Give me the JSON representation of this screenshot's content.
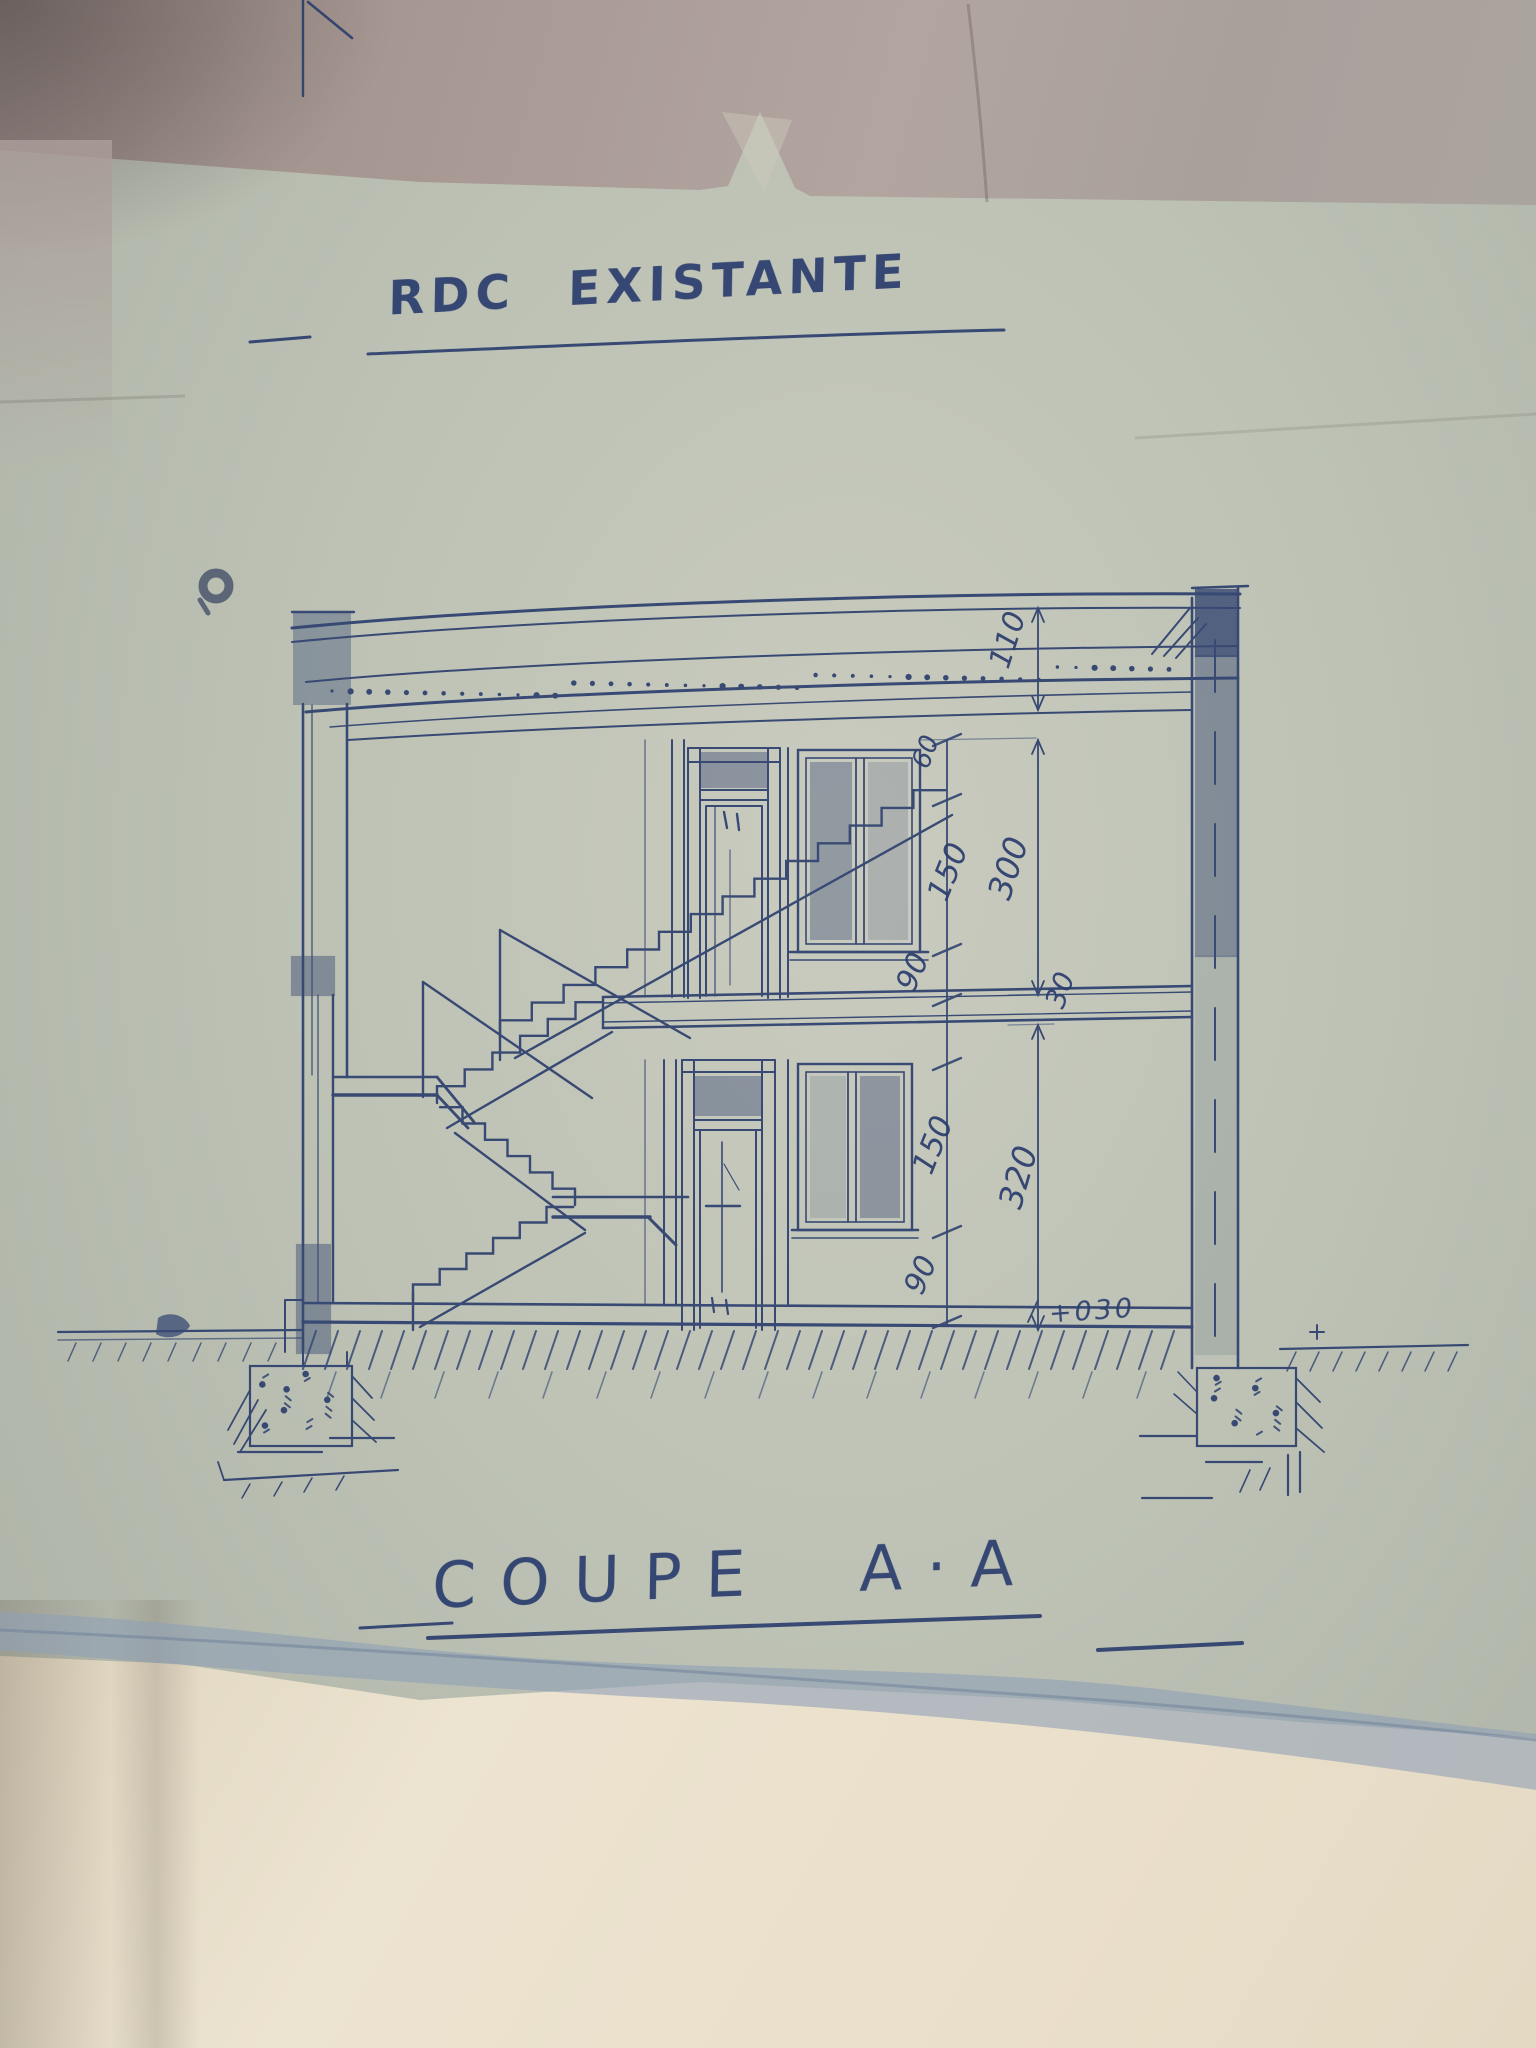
{
  "titles": {
    "plan": "RDC EXISTANTE",
    "section": "COUPE A·A"
  },
  "dims": {
    "roof_parapet": "110",
    "upper": {
      "lintel": "60",
      "window": "150",
      "sill": "90",
      "storey": "300",
      "slab": "30"
    },
    "lower": {
      "window": "150",
      "sill": "90",
      "storey": "320",
      "ground_level": "+030"
    }
  },
  "colors": {
    "ink": "#2c3f6e",
    "ink2": "#46598a",
    "paper": "#b9beb2",
    "foldtop": "#ab9d99",
    "band": "#8fa0b5",
    "cream": "#e9e0cb"
  }
}
